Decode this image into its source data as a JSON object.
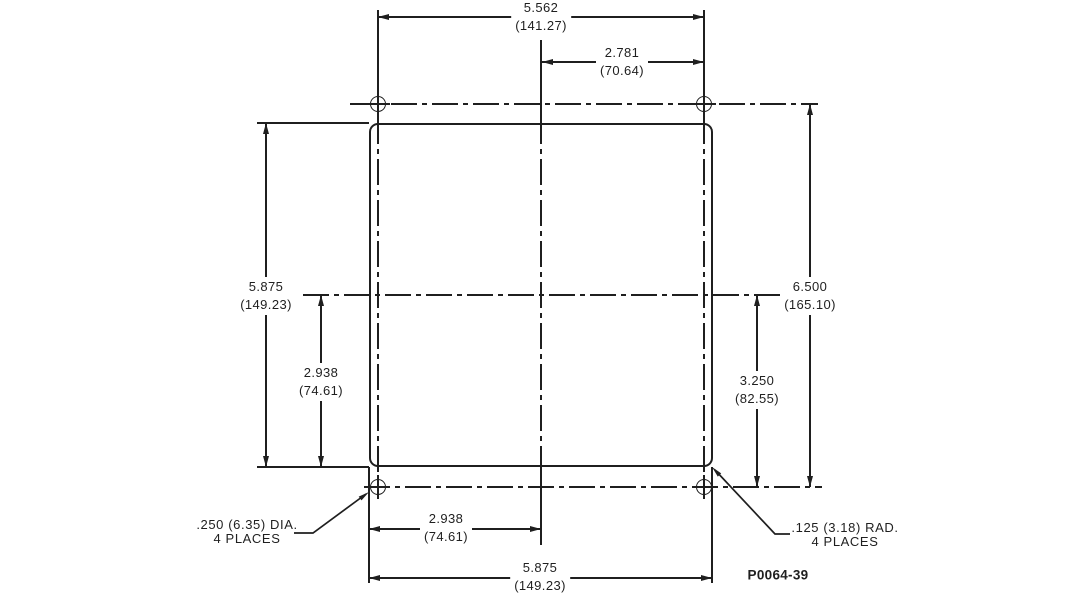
{
  "drawing": {
    "part_number": "P0064-39",
    "dimensions": {
      "top_width": {
        "inches": "5.562",
        "mm": "(141.27)"
      },
      "top_half": {
        "inches": "2.781",
        "mm": "(70.64)"
      },
      "left_height": {
        "inches": "5.875",
        "mm": "(149.23)"
      },
      "left_half": {
        "inches": "2.938",
        "mm": "(74.61)"
      },
      "right_height": {
        "inches": "6.500",
        "mm": "(165.10)"
      },
      "right_half": {
        "inches": "3.250",
        "mm": "(82.55)"
      },
      "bottom_half": {
        "inches": "2.938",
        "mm": "(74.61)"
      },
      "bottom_width": {
        "inches": "5.875",
        "mm": "(149.23)"
      }
    },
    "notes": {
      "hole_diameter": {
        "line1": ".250 (6.35) DIA.",
        "line2": "4 PLACES"
      },
      "corner_radius": {
        "line1": ".125 (3.18) RAD.",
        "line2": "4 PLACES"
      }
    },
    "line_color": "#1f1f1f"
  }
}
